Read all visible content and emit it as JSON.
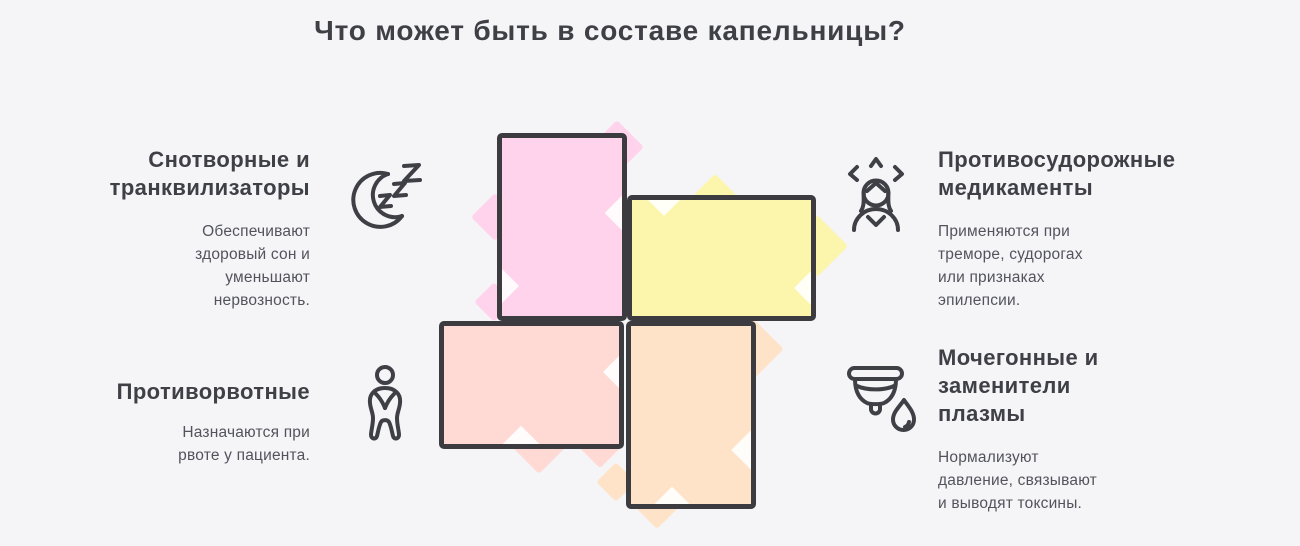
{
  "title": "Что может быть в составе капельницы?",
  "items": [
    {
      "id": "sedatives",
      "heading": "Снотворные и\nтранквилизаторы",
      "body": "Обеспечивают\nздоровый сон и\nуменьшают\nнервозность.",
      "icon": "moon-zzz-icon",
      "cell_color": "#FFD3EB"
    },
    {
      "id": "anticonvulsants",
      "heading": "Противосудорожные\nмедикаменты",
      "body": "Применяются при\nтреморе, судорогах\nили признаках\nэпилепсии.",
      "icon": "tremor-person-icon",
      "cell_color": "#FCF5AC"
    },
    {
      "id": "antiemetics",
      "heading": "Противорвотные",
      "body": "Назначаются при\nрвоте у пациента.",
      "icon": "nausea-person-icon",
      "cell_color": "#FFD9D4"
    },
    {
      "id": "diuretics",
      "heading": "Мочегонные и\nзаменители\nплазмы",
      "body": "Нормализуют\nдавление, связывают\nи выводят токсины.",
      "icon": "cup-drop-icon",
      "cell_color": "#FEE3C8"
    }
  ],
  "colors": {
    "background": "#F5F5F8",
    "stroke": "#3B3B40",
    "heading": "#3F3F46",
    "body_text": "#53535C",
    "pink": "#FFD3EB",
    "yellow": "#FCF5AC",
    "salmon": "#FFD9D4",
    "peach": "#FEE3C8"
  }
}
